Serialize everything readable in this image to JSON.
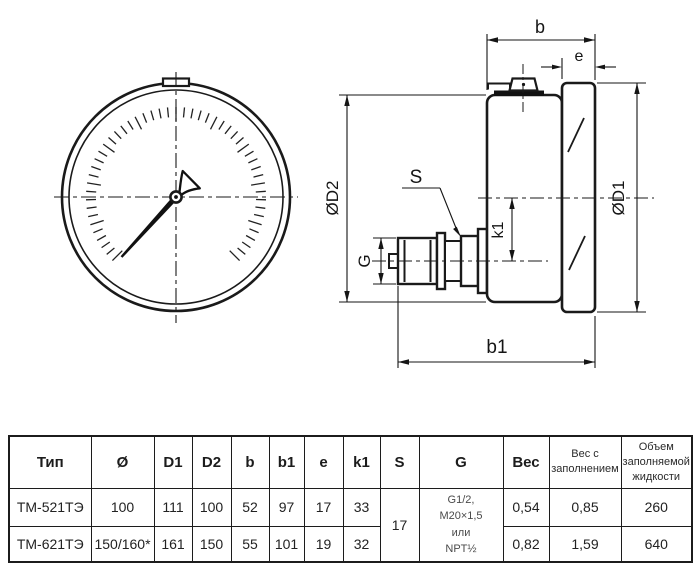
{
  "drawing": {
    "labels": {
      "b": "b",
      "e": "e",
      "d2": "ØD2",
      "d1": "ØD1",
      "s": "S",
      "k1": "k1",
      "g": "G",
      "b1": "b1"
    },
    "line_color": "#1a1a1a"
  },
  "table": {
    "headers": [
      "Тип",
      "Ø",
      "D1",
      "D2",
      "b",
      "b1",
      "e",
      "k1",
      "S",
      "G",
      "Вес",
      "Вес с заполнением",
      "Объем заполняемой жидкости"
    ],
    "rows": [
      {
        "type": "ТМ-521ТЭ",
        "diameter": "100",
        "d1": "111",
        "d2": "100",
        "b": "52",
        "b1": "97",
        "e": "17",
        "k1": "33",
        "weight": "0,54",
        "weight_filled": "0,85",
        "volume": "260"
      },
      {
        "type": "ТМ-621ТЭ",
        "diameter": "150/160*",
        "d1": "161",
        "d2": "150",
        "b": "55",
        "b1": "101",
        "e": "19",
        "k1": "32",
        "weight": "0,82",
        "weight_filled": "1,59",
        "volume": "640"
      }
    ],
    "s_merged": "17",
    "g_lines": [
      "G1/2,",
      "М20×1,5",
      "или",
      "NPT½"
    ]
  }
}
